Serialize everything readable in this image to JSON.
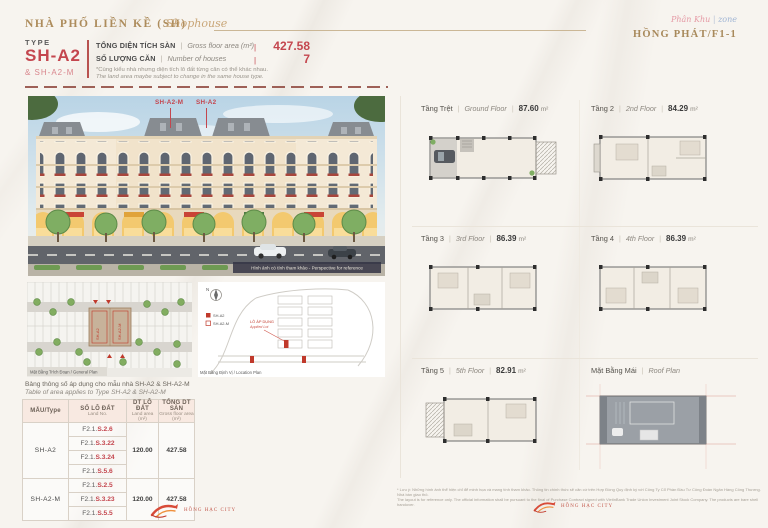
{
  "colors": {
    "accent_red": "#c4464e",
    "accent_gold": "#ad8c5c",
    "header_bg": "#f8e9e1"
  },
  "misc": {
    "pipe": "|"
  },
  "header": {
    "title_vi": "NHÀ PHỐ LIỀN KỀ (SH)",
    "title_script": "Shophouse",
    "zone_vi": "Phân Khu",
    "zone_sep": "|",
    "zone_en": "zone",
    "zone_name": "HỒNG PHÁT/F1-1"
  },
  "type_block": {
    "type_label": "TYPE",
    "code": "SH-A2",
    "code_sub": "& SH-A2-M",
    "spec_rows": [
      {
        "vi": "TỔNG DIỆN TÍCH SÀN",
        "en": "Gross floor area (m²)",
        "value": "427.58"
      },
      {
        "vi": "SỐ LƯỢNG CĂN",
        "en": "Number of houses",
        "value": "7"
      }
    ],
    "note_vi": "*Cùng kiểu nhà nhưng diện tích lô đất từng căn có thể khác nhau.",
    "note_en": "The land area maybe subject to change in the same house type."
  },
  "rendering": {
    "label_m": "SH-A2-M",
    "label_a": "SH-A2",
    "caption": "Hình ảnh có tính tham khảo - Perspective for reference"
  },
  "plans_small": {
    "general_caption": "Mặt Bằng Trích Đoạn / General Plan",
    "location_caption": "Mặt Bằng Định Vị / Location Plan",
    "north": "N",
    "legend": [
      {
        "label": "SH-A2"
      },
      {
        "label": "SH-A2-M"
      }
    ],
    "applied_vi": "LÔ ÁP DỤNG",
    "applied_en": "Applied Lot",
    "block_marks": [
      "SH-A2",
      "SH-A2-M"
    ]
  },
  "table_intro": {
    "vi": "Bảng thông số áp dụng cho mẫu nhà SH-A2 & SH-A2-M",
    "en": "Table of area applies to Type SH-A2 & SH-A2-M"
  },
  "area_table": {
    "headers": [
      {
        "vi": "MẪU/Type",
        "en": ""
      },
      {
        "vi": "SỐ LÔ ĐẤT",
        "en": "Land No."
      },
      {
        "vi": "DT LÔ ĐẤT",
        "en": "Land area (m²)"
      },
      {
        "vi": "TỔNG DT SÀN",
        "en": "Gross floor area (m²)"
      }
    ],
    "groups": [
      {
        "type": "SH-A2",
        "lots": [
          {
            "prefix": "F2.1.",
            "code": "S.2.6"
          },
          {
            "prefix": "F2.1.",
            "code": "S.3.22"
          },
          {
            "prefix": "F2.1.",
            "code": "S.3.24"
          },
          {
            "prefix": "F2.1.",
            "code": "S.5.6"
          }
        ],
        "land": "120.00",
        "gross": "427.58"
      },
      {
        "type": "SH-A2-M",
        "lots": [
          {
            "prefix": "F2.1.",
            "code": "S.2.5"
          },
          {
            "prefix": "F2.1.",
            "code": "S.3.23"
          },
          {
            "prefix": "F2.1.",
            "code": "S.5.5"
          }
        ],
        "land": "120.00",
        "gross": "427.58"
      }
    ]
  },
  "floors": [
    {
      "vi": "Tầng Trệt",
      "en": "Ground Floor",
      "sep2": "|",
      "area": "87.60",
      "unit": "m²"
    },
    {
      "vi": "Tầng 2",
      "en": "2nd Floor",
      "sep2": "|",
      "area": "84.29",
      "unit": "m²"
    },
    {
      "vi": "Tầng 3",
      "en": "3rd Floor",
      "sep2": "|",
      "area": "86.39",
      "unit": "m²"
    },
    {
      "vi": "Tầng 4",
      "en": "4th Floor",
      "sep2": "|",
      "area": "86.39",
      "unit": "m²"
    },
    {
      "vi": "Tầng 5",
      "en": "5th Floor",
      "sep2": "|",
      "area": "82.91",
      "unit": "m²"
    },
    {
      "vi": "Mặt Bằng Mái",
      "en": "Roof Plan",
      "sep2": "",
      "area": "",
      "unit": ""
    }
  ],
  "footer": {
    "disclaimer_vi": "* Lưu ý: Những hình ảnh thể hiện chỉ để minh họa và mang tính tham khảo. Thông tin chính thức sẽ căn cứ trên Hợp Đồng Quy định ký với Công Ty Cổ Phần Đầu Tư Công Đoàn Ngân Hàng Công Thương. Nhà bàn giao thô.",
    "disclaimer_en": "The layout is for reference only. The official information shall be pursuant to the final of Purchase Contract signed with VietinBank Trade Union Investment Joint Stock Company. The products are bare shell handover.",
    "logo_left": "HỒNG HẠC CITY",
    "logo_right": "HỒNG HẠC CITY"
  }
}
